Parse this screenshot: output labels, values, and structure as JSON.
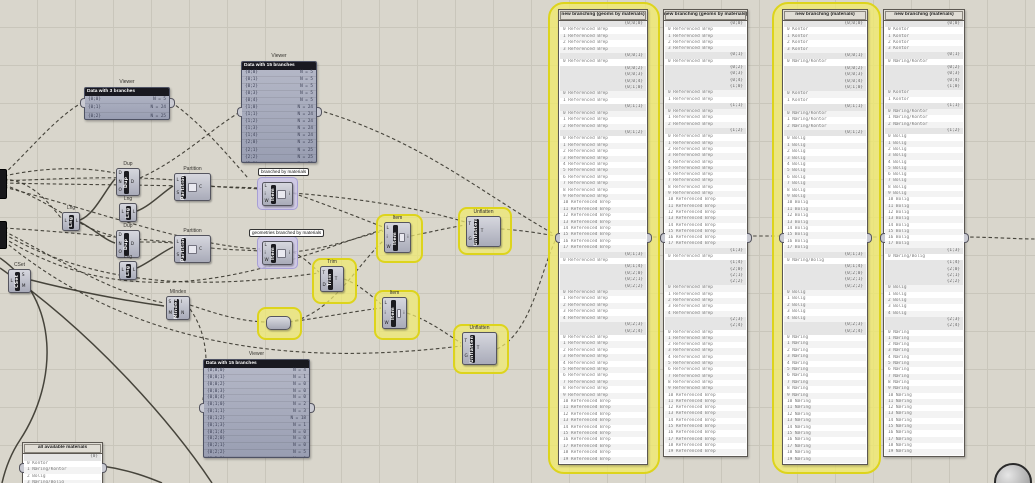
{
  "canvas": {
    "accent_yellow": "#ddd41c",
    "accent_purple": "#a79fd6",
    "wire_color": "#3a372f"
  },
  "groups": {
    "gA": {
      "label": "branched by materials"
    },
    "gB": {
      "label": "geometries branched by materials"
    }
  },
  "components": {
    "dup1": {
      "label": "Dup",
      "name": "Dup",
      "in": [
        "D",
        "N",
        "O"
      ],
      "out": [
        "D"
      ],
      "icon": false
    },
    "dup2": {
      "label": "Dup",
      "name": "Dup",
      "in": [
        "D",
        "N",
        "O"
      ],
      "out": [
        "D"
      ],
      "icon": false
    },
    "lng0": {
      "label": "Lng",
      "name": "Lng",
      "in": [
        "L"
      ],
      "out": [
        "L"
      ],
      "icon": false
    },
    "lng1": {
      "label": "Lng",
      "name": "Lng",
      "in": [
        "L"
      ],
      "out": [
        "L"
      ],
      "icon": false
    },
    "lng2": {
      "label": "Lng",
      "name": "Lng",
      "in": [
        "L"
      ],
      "out": [
        "L"
      ],
      "icon": false
    },
    "partition1": {
      "label": "Partition",
      "name": "Partition",
      "in": [
        "L",
        "S"
      ],
      "out": [
        "C"
      ],
      "icon": true
    },
    "partition2": {
      "label": "Partition",
      "name": "Partition",
      "in": [
        "L",
        "S"
      ],
      "out": [
        "C"
      ],
      "icon": true
    },
    "cset": {
      "label": "CSet",
      "name": "CSet",
      "in": [
        "L"
      ],
      "out": [
        "S",
        "M"
      ],
      "icon": false
    },
    "mindex": {
      "label": "MIndex",
      "name": "MIndex",
      "in": [
        "S",
        "M"
      ],
      "out": [
        "I",
        "N"
      ],
      "icon": false
    },
    "itemA": {
      "label": "Item",
      "name": "Item",
      "in": [
        "L",
        "i",
        "W"
      ],
      "out": [
        "i"
      ],
      "icon": true
    },
    "itemB": {
      "label": "Item",
      "name": "Item",
      "in": [
        "L",
        "i",
        "W"
      ],
      "out": [
        "i"
      ],
      "icon": true
    },
    "item1": {
      "label": "Item",
      "name": "Item",
      "in": [
        "L",
        "i",
        "W"
      ],
      "out": [
        "i"
      ],
      "icon": true
    },
    "item2": {
      "label": "Item",
      "name": "Item",
      "in": [
        "L",
        "i",
        "W"
      ],
      "out": [
        "i"
      ],
      "icon": true
    },
    "trim": {
      "label": "Trim",
      "name": "Trim",
      "in": [
        "T",
        "D"
      ],
      "out": [
        "T"
      ],
      "icon": false
    },
    "unflatten1": {
      "label": "Unflatten",
      "name": "Unflatten",
      "in": [
        "T",
        "G"
      ],
      "out": [
        "T"
      ],
      "icon": false
    },
    "unflatten2": {
      "label": "Unflatten",
      "name": "Unflatten",
      "in": [
        "T",
        "G"
      ],
      "out": [
        "T"
      ],
      "icon": false
    }
  },
  "viewers": {
    "v1": {
      "label": "Viewer",
      "title": "Data with 3 branches",
      "rows": [
        {
          "path": "{0;0}",
          "n": "N = 5"
        },
        {
          "path": "{0;1}",
          "n": "N = 24"
        },
        {
          "path": "{0;2}",
          "n": "N = 25"
        }
      ]
    },
    "v2": {
      "label": "Viewer",
      "title": "Data with 15 branches",
      "rows": [
        {
          "path": "{0;0}",
          "n": "N = 5"
        },
        {
          "path": "{0;1}",
          "n": "N = 5"
        },
        {
          "path": "{0;2}",
          "n": "N = 5"
        },
        {
          "path": "{0;3}",
          "n": "N = 5"
        },
        {
          "path": "{0;4}",
          "n": "N = 5"
        },
        {
          "path": "{1;0}",
          "n": "N = 24"
        },
        {
          "path": "{1;1}",
          "n": "N = 24"
        },
        {
          "path": "{1;2}",
          "n": "N = 24"
        },
        {
          "path": "{1;3}",
          "n": "N = 24"
        },
        {
          "path": "{1;4}",
          "n": "N = 24"
        },
        {
          "path": "{2;0}",
          "n": "N = 25"
        },
        {
          "path": "{2;1}",
          "n": "N = 25"
        },
        {
          "path": "{2;2}",
          "n": "N = 25"
        },
        {
          "path": "{2;3}",
          "n": "N = 25"
        },
        {
          "path": "{2;4}",
          "n": "N = 25"
        }
      ]
    },
    "v3": {
      "label": "Viewer",
      "title": "Data with 15 branches",
      "rows": [
        {
          "path": "{0;0;0}",
          "n": "N = 4"
        },
        {
          "path": "{0;0;1}",
          "n": "N = 1"
        },
        {
          "path": "{0;0;2}",
          "n": "N = 0"
        },
        {
          "path": "{0;0;3}",
          "n": "N = 0"
        },
        {
          "path": "{0;0;4}",
          "n": "N = 0"
        },
        {
          "path": "{0;1;0}",
          "n": "N = 2"
        },
        {
          "path": "{0;1;1}",
          "n": "N = 3"
        },
        {
          "path": "{0;1;2}",
          "n": "N = 18"
        },
        {
          "path": "{0;1;3}",
          "n": "N = 1"
        },
        {
          "path": "{0;1;4}",
          "n": "N = 0"
        },
        {
          "path": "{0;2;0}",
          "n": "N = 0"
        },
        {
          "path": "{0;2;1}",
          "n": "N = 0"
        },
        {
          "path": "{0;2;2}",
          "n": "N = 5"
        },
        {
          "path": "{0;2;3}",
          "n": "N = 0"
        },
        {
          "path": "{0;2;4}",
          "n": "N = 20"
        }
      ]
    }
  },
  "panels": {
    "materials": {
      "title": "all available materials",
      "branches": [
        {
          "path": "{0}",
          "items": [
            "0 Kontor",
            "1 Næring/Kontor",
            "2 Bolig",
            "3 Næring/Bolig"
          ]
        }
      ]
    },
    "p1": {
      "title": "new branching (geoms by materials)",
      "item": "Referenced Brep",
      "branches": [
        {
          "path": "{0;0;0}",
          "count": 4
        },
        {
          "path": "{0;0;1}",
          "count": 1
        },
        {
          "path": "{0;0;2}",
          "count": 0
        },
        {
          "path": "{0;0;3}",
          "count": 0
        },
        {
          "path": "{0;0;4}",
          "count": 0
        },
        {
          "path": "{0;1;0}",
          "count": 2
        },
        {
          "path": "{0;1;1}",
          "count": 3
        },
        {
          "path": "{0;1;2}",
          "count": 18
        },
        {
          "path": "{0;1;3}",
          "count": 1
        },
        {
          "path": "{0;1;4}",
          "count": 0
        },
        {
          "path": "{0;2;0}",
          "count": 0
        },
        {
          "path": "{0;2;1}",
          "count": 0
        },
        {
          "path": "{0;2;2}",
          "count": 5
        },
        {
          "path": "{0;2;3}",
          "count": 0
        },
        {
          "path": "{0;2;4}",
          "count": 20
        }
      ]
    },
    "p2": {
      "title": "new branching (geoms by materials)",
      "item": "Referenced Brep",
      "branches": [
        {
          "path": "{0;0}",
          "count": 4
        },
        {
          "path": "{0;1}",
          "count": 1
        },
        {
          "path": "{0;2}",
          "count": 0
        },
        {
          "path": "{0;3}",
          "count": 0
        },
        {
          "path": "{0;4}",
          "count": 0
        },
        {
          "path": "{1;0}",
          "count": 2
        },
        {
          "path": "{1;1}",
          "count": 3
        },
        {
          "path": "{1;2}",
          "count": 18
        },
        {
          "path": "{1;3}",
          "count": 1
        },
        {
          "path": "{1;4}",
          "count": 0
        },
        {
          "path": "{2;0}",
          "count": 0
        },
        {
          "path": "{2;1}",
          "count": 0
        },
        {
          "path": "{2;2}",
          "count": 5
        },
        {
          "path": "{2;3}",
          "count": 0
        },
        {
          "path": "{2;4}",
          "count": 20
        }
      ]
    },
    "p3": {
      "title": "new branching (materials)",
      "item": "",
      "branches": [
        {
          "path": "{0;0;0}",
          "count": 4,
          "item": "Kontor"
        },
        {
          "path": "{0;0;1}",
          "count": 1,
          "item": "Næring/Kontor"
        },
        {
          "path": "{0;0;2}",
          "count": 0
        },
        {
          "path": "{0;0;3}",
          "count": 0
        },
        {
          "path": "{0;0;4}",
          "count": 0
        },
        {
          "path": "{0;1;0}",
          "count": 2,
          "item": "Kontor"
        },
        {
          "path": "{0;1;1}",
          "count": 3,
          "item": "Næring/Kontor"
        },
        {
          "path": "{0;1;2}",
          "count": 18,
          "item": "Bolig"
        },
        {
          "path": "{0;1;3}",
          "count": 1,
          "item": "Næring/Bolig"
        },
        {
          "path": "{0;1;4}",
          "count": 0
        },
        {
          "path": "{0;2;0}",
          "count": 0
        },
        {
          "path": "{0;2;1}",
          "count": 0
        },
        {
          "path": "{0;2;2}",
          "count": 5,
          "item": "Bolig"
        },
        {
          "path": "{0;2;3}",
          "count": 0
        },
        {
          "path": "{0;2;4}",
          "count": 20,
          "item": "Næring"
        }
      ]
    },
    "p4": {
      "title": "new branching (materials)",
      "item": "",
      "branches": [
        {
          "path": "{0;0}",
          "count": 4,
          "item": "Kontor"
        },
        {
          "path": "{0;1}",
          "count": 1,
          "item": "Næring/Kontor"
        },
        {
          "path": "{0;2}",
          "count": 0
        },
        {
          "path": "{0;3}",
          "count": 0
        },
        {
          "path": "{0;4}",
          "count": 0
        },
        {
          "path": "{1;0}",
          "count": 2,
          "item": "Kontor"
        },
        {
          "path": "{1;1}",
          "count": 3,
          "item": "Næring/Kontor"
        },
        {
          "path": "{1;2}",
          "count": 18,
          "item": "Bolig"
        },
        {
          "path": "{1;3}",
          "count": 1,
          "item": "Næring/Bolig"
        },
        {
          "path": "{1;4}",
          "count": 0
        },
        {
          "path": "{2;0}",
          "count": 0
        },
        {
          "path": "{2;1}",
          "count": 0
        },
        {
          "path": "{2;2}",
          "count": 5,
          "item": "Bolig"
        },
        {
          "path": "{2;3}",
          "count": 0
        },
        {
          "path": "{2;4}",
          "count": 20,
          "item": "Næring"
        }
      ]
    }
  }
}
